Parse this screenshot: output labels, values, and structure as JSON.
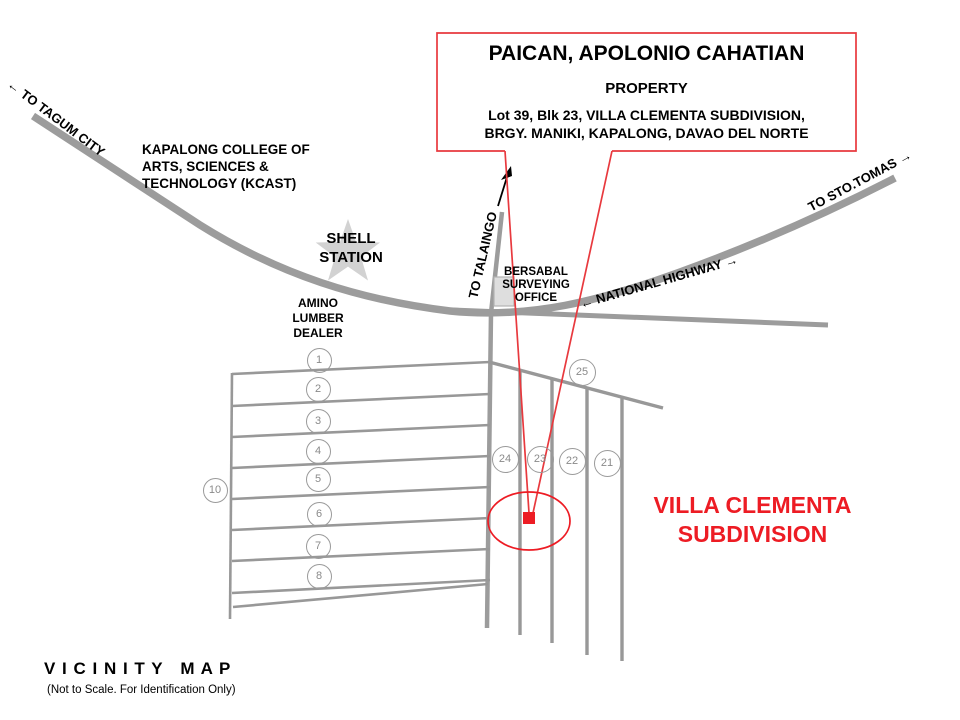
{
  "title_box": {
    "owner": "PAICAN, APOLONIO CAHATIAN",
    "property": "PROPERTY",
    "address_line1": "Lot 39, Blk 23, VILLA CLEMENTA SUBDIVISION,",
    "address_line2": "BRGY. MANIKI, KAPALONG, DAVAO DEL NORTE"
  },
  "road_labels": {
    "to_tagum": "← TO TAGUM CITY",
    "to_sto_tomas": "TO STO.TOMAS →",
    "national_highway": "← NATIONAL HIGHWAY →",
    "to_talaingo": "TO TALAINGO"
  },
  "landmarks": {
    "kcast_line1": "KAPALONG COLLEGE OF",
    "kcast_line2": "ARTS, SCIENCES &",
    "kcast_line3": "TECHNOLOGY (KCAST)",
    "shell_line1": "SHELL",
    "shell_line2": "STATION",
    "amino_line1": "AMINO",
    "amino_line2": "LUMBER",
    "amino_line3": "DEALER",
    "bersabal_line1": "BERSABAL",
    "bersabal_line2": "SURVEYING",
    "bersabal_line3": "OFFICE"
  },
  "subdivision": {
    "name_line1": "VILLA CLEMENTA",
    "name_line2": "SUBDIVISION",
    "left_blocks": [
      "1",
      "2",
      "3",
      "4",
      "5",
      "6",
      "7",
      "8"
    ],
    "outer_block": "10",
    "right_blocks": [
      "24",
      "23",
      "22",
      "21"
    ],
    "top_block": "25"
  },
  "footer": {
    "title": "V I C I N I T Y   M A P",
    "subtitle": "(Not to Scale. For Identification Only)"
  },
  "colors": {
    "road_gray": "#9C9C9C",
    "block_line_gray": "#989898",
    "accent_red": "#ED1C24",
    "callout_red": "#E8393E",
    "star_gray": "#D2D2D2"
  }
}
